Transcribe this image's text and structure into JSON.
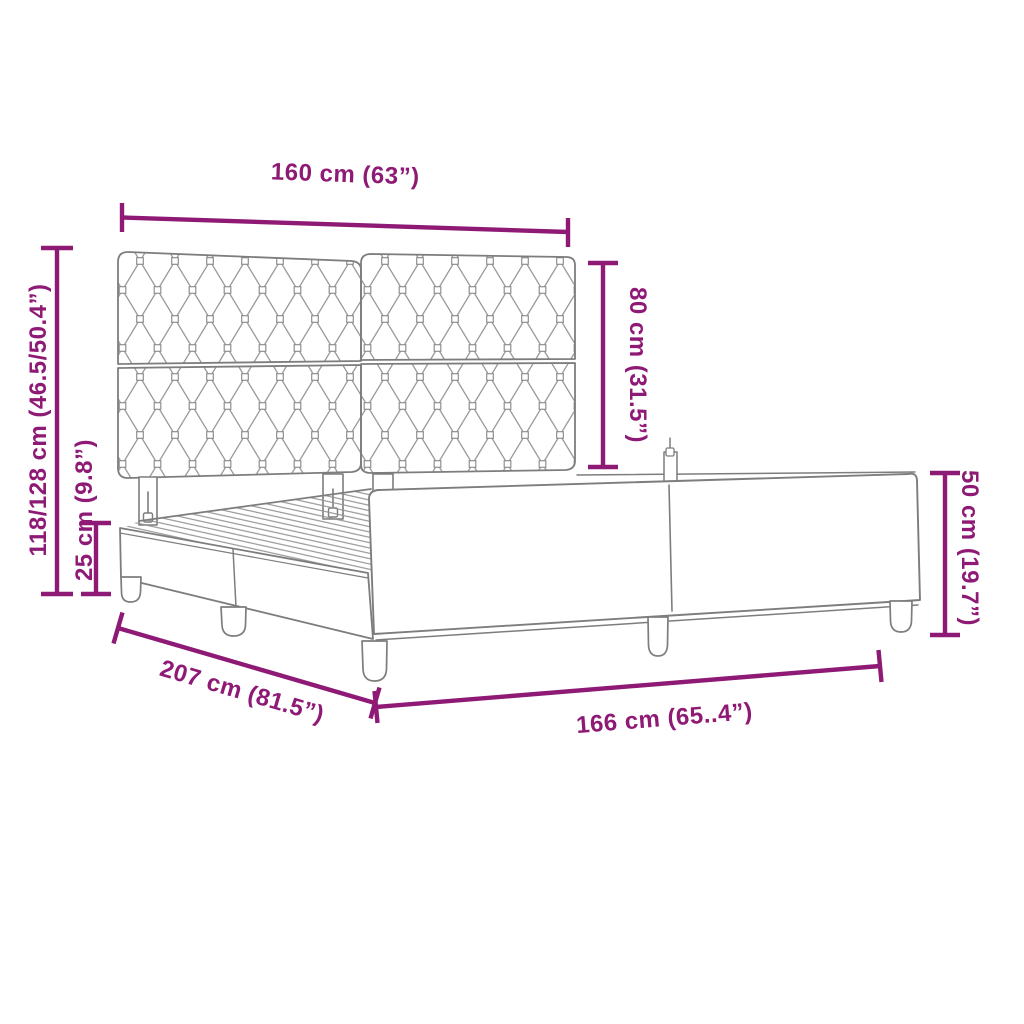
{
  "diagram": {
    "type": "product-dimension-diagram",
    "product": "upholstered bed frame with tufted headboard",
    "accent_color": "#8e1a75",
    "drawing_line_color": "#7d7d7d",
    "pattern_line_color": "#9a9a9a",
    "background_color": "#ffffff",
    "dimensions": {
      "headboard_width": "160 cm (63”)",
      "headboard_height": "80 cm (31.5”)",
      "total_height": "118/128 cm (46.5/50.4”)",
      "base_height": "25 cm (9.8”)",
      "frame_length": "207 cm (81.5”)",
      "frame_width": "166 cm (65..4”)",
      "footboard_height": "50 cm (19.7”)"
    }
  }
}
